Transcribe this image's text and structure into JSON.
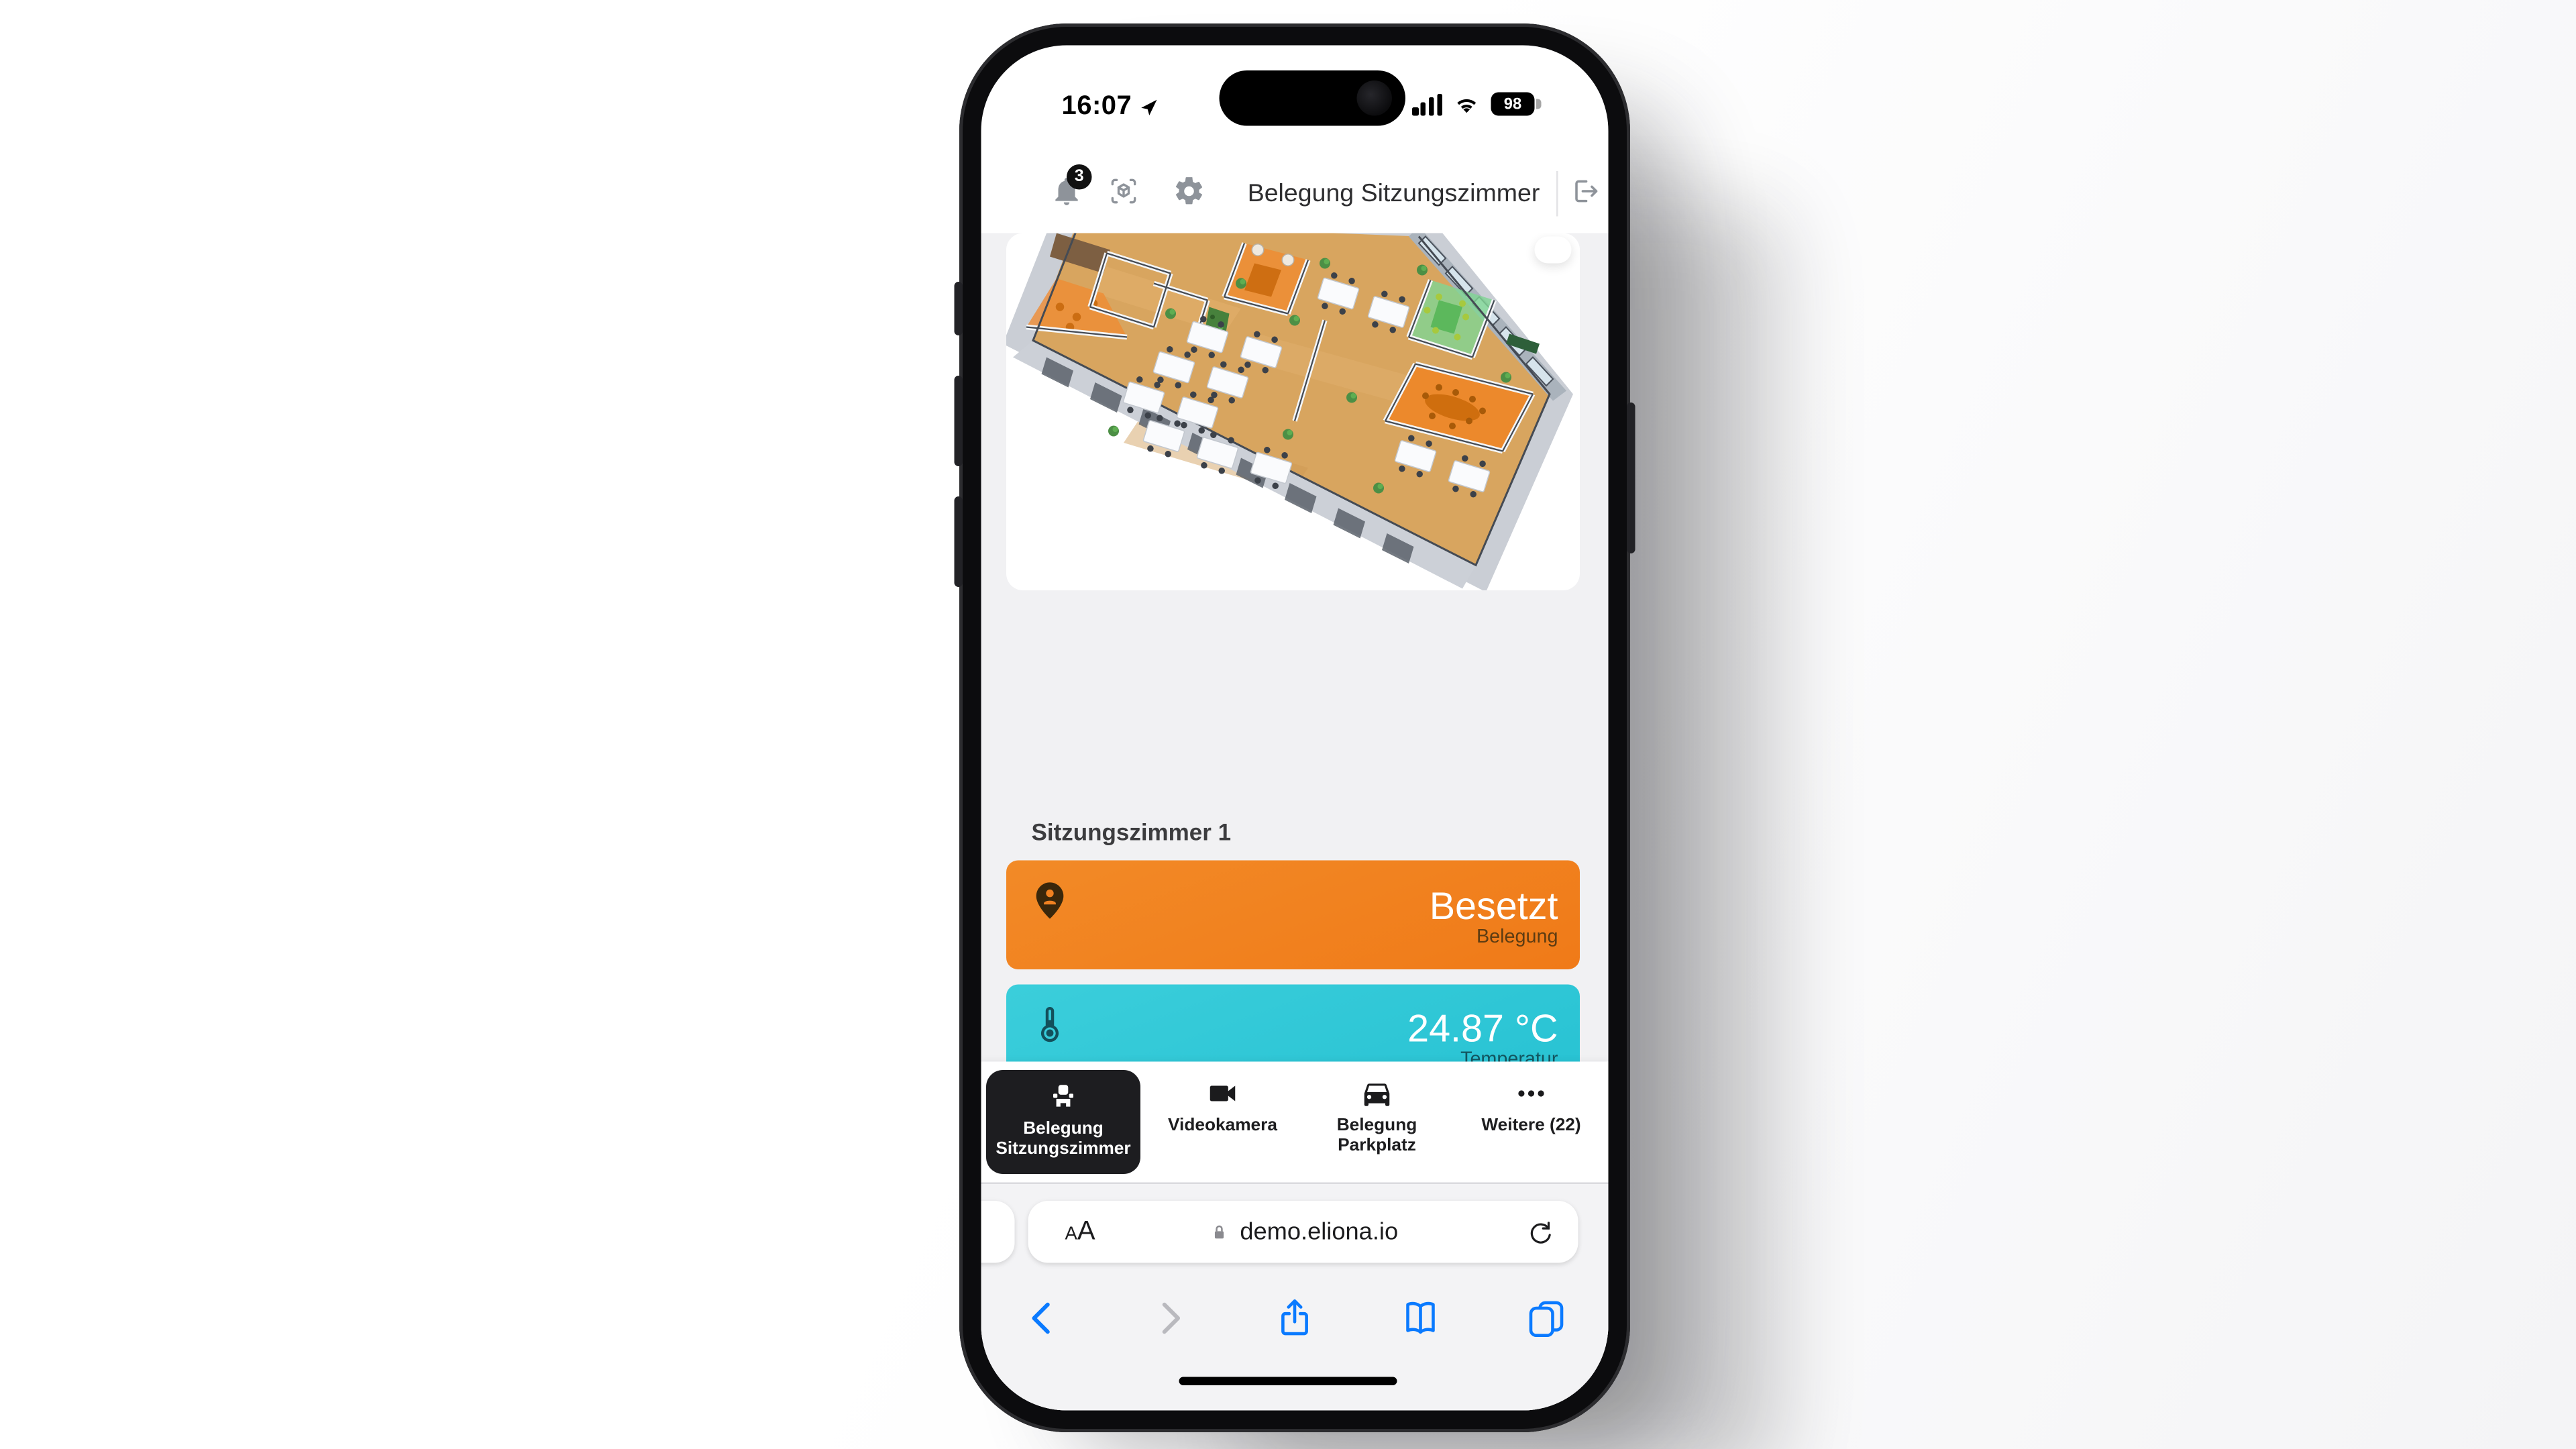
{
  "status_bar": {
    "time": "16:07",
    "battery_percent": "98",
    "icons": [
      "location-arrow-icon",
      "cellular-signal-icon",
      "wifi-icon",
      "battery-icon"
    ]
  },
  "app": {
    "header": {
      "title": "Belegung Sitzungszimmer",
      "notification_badge": "3",
      "icons": [
        "bell-icon",
        "ar-cube-scan-icon",
        "settings-gear-icon",
        "logout-icon"
      ]
    },
    "room_section": {
      "title": "Sitzungszimmer 1"
    },
    "metric_cards": [
      {
        "value": "Besetzt",
        "label": "Belegung",
        "color": "#f0801f",
        "icon": "location-pin-person-icon"
      },
      {
        "value": "24.87 °C",
        "label": "Temperatur",
        "color": "#2fc8d7",
        "icon": "thermometer-icon"
      },
      {
        "value": "Gute Luftqualität",
        "label": "CO2 Gehalt",
        "color": "#5ecd80",
        "icon": "co2-cloud-icon"
      }
    ],
    "tab_bar": {
      "items": [
        {
          "lines": [
            "Belegung",
            "Sitzungszimmer"
          ],
          "icon": "meeting-room-seat-icon",
          "active": true
        },
        {
          "lines": [
            "Videokamera"
          ],
          "icon": "video-camera-icon",
          "active": false
        },
        {
          "lines": [
            "Belegung",
            "Parkplatz"
          ],
          "icon": "car-icon",
          "active": false
        },
        {
          "lines": [
            "Weitere (22)"
          ],
          "icon": "more-ellipsis-icon",
          "active": false
        }
      ],
      "active_tab_bg": "#1d1d20"
    }
  },
  "browser": {
    "text_size_small": "A",
    "text_size_large": "A",
    "url": "demo.eliona.io",
    "url_icons": [
      "lock-icon",
      "reload-icon"
    ],
    "toolbar_icons": [
      "back-icon",
      "forward-icon",
      "share-icon",
      "bookmarks-icon",
      "tabs-icon"
    ],
    "accent_blue": "#0a7aff"
  }
}
